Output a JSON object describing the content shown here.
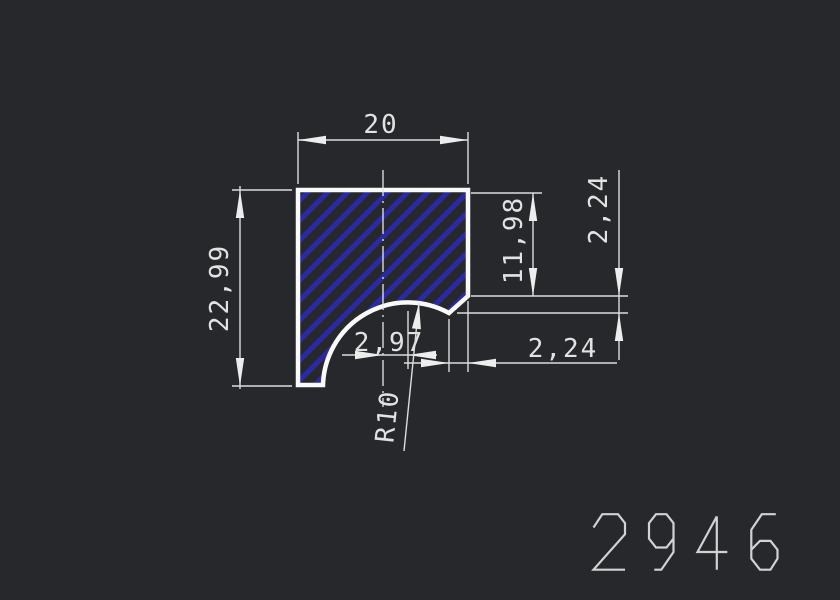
{
  "drawing": {
    "title_number": "2946",
    "dimensions": {
      "width": "20",
      "height": "22,99",
      "side_depth": "11,98",
      "notch_height": "2,24",
      "notch_width": "2,24",
      "center_offset": "2,97",
      "radius": "R10"
    },
    "colors": {
      "background": "#26282b",
      "profile_outline": "#fafafa",
      "hatch_blue": "#2a2aa8",
      "dimension_lines": "#dcdcdc",
      "plot_number": "#d2d2d2"
    }
  }
}
